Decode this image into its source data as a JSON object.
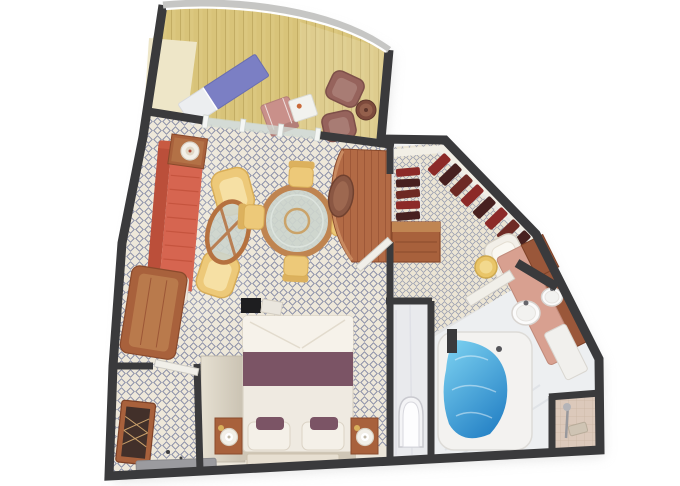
{
  "image": {
    "kind": "3d-floorplan-render",
    "subject": "suite floor plan with balcony, living room, walk-in closet, bedroom and bathroom"
  },
  "palette": {
    "walls": "#3a3a3c",
    "railing": "#c6c6c4",
    "railing_inner": "#ffffff",
    "deck": "#dbc77f",
    "deck_line": "#c3ad64",
    "cream_wall": "#eee6c8",
    "carpet": "#eee8da",
    "carpet_lattice": "#70789a",
    "tile": "#ece5d4",
    "tile_lattice": "#8890a8",
    "sofa": "#d66550",
    "sofa_back": "#bb4f3a",
    "sofa_cushion": "#efe9e0",
    "wood": "#a8613c",
    "wood_top": "#c08552",
    "desk_wood": "#b26a45",
    "desk_wood_line": "#9c5636",
    "armchair": "#edc979",
    "armchair_inner": "#f6e0a4",
    "armchair_edge": "#d9ae58",
    "dining_glass": "#ccd4cc",
    "table_rim": "#bf8450",
    "chaise_blue": "#7b7fc4",
    "chaise_foot": "#eceef0",
    "balcony_chair_pink": "#c9908a",
    "balcony_chair_mauve": "#96635c",
    "side_table_brown": "#7d4a3c",
    "clothes_a": "#8c2a28",
    "clothes_b": "#47201f",
    "clothes_c": "#6e2a24",
    "rail_white": "#e8e8e6",
    "bed_duvet": "#efeae1",
    "bed_fold": "#f6f2ea",
    "bed_runner": "#7b5465",
    "headboard": "#cfc6b6",
    "wardrobe": "#ddd6c7",
    "walkway": "#ece6da",
    "rug": "#e7dfd1",
    "wc_floor": "#e9eaed",
    "toilet": "#f4f4f6",
    "bath_floor": "#edeff1",
    "tub": "#f3f2f0",
    "water_top": "#7fd4f2",
    "water_deep": "#2a86c8",
    "counter": "#d8a090",
    "vanity_wood": "#9a573a",
    "cabinet_white": "#f1f0ed",
    "shower_tile": "#dcc9bb",
    "shower_tile_line": "#cbb6a5",
    "stool": "#e9c568",
    "mat": "#9b9b9f",
    "mirror_wood": "#a8613c",
    "mirror_glass": "#42302a",
    "door_leaf": "#f1efe9",
    "glass_divider": "#cfd8d2",
    "tv": "#1e1e20",
    "desk_chair": "#8a5743",
    "lamp": "#f2efe8",
    "dresser": "#a8613c",
    "nightstand": "#a8613c",
    "shadow": "#c9c9c9"
  },
  "rooms": [
    {
      "name": "balcony",
      "floor": "wood-deck",
      "furniture": [
        "chaise-lounge",
        "folding-chair",
        "small-table",
        "lounge-chair",
        "lounge-chair",
        "round-side-table"
      ]
    },
    {
      "name": "living-room",
      "floor": "lattice-carpet",
      "furniture": [
        "l-shaped-sofa",
        "side-table-with-lamp",
        "tub-armchair",
        "tub-armchair",
        "oval-coffee-table",
        "round-dining-table",
        "dining-chair",
        "dining-chair",
        "dining-chair",
        "dining-chair",
        "curved-desk",
        "desk-chair",
        "tv-cabinet",
        "tv"
      ]
    },
    {
      "name": "walk-in-closet",
      "floor": "mosaic-tile",
      "furniture": [
        "hanging-rail",
        "hanging-rail",
        "garments",
        "dresser"
      ]
    },
    {
      "name": "dressing-area",
      "floor": "mosaic-tile",
      "furniture": [
        "vanity-table",
        "round-stool"
      ]
    },
    {
      "name": "bedroom",
      "floor": "lattice-carpet",
      "furniture": [
        "double-bed",
        "pillows",
        "accent-runner",
        "nightstand",
        "nightstand",
        "lamps",
        "wardrobe",
        "rug"
      ]
    },
    {
      "name": "entry-hall",
      "floor": "lattice-carpet",
      "furniture": [
        "framed-mirror",
        "door-mat",
        "entry-door"
      ]
    },
    {
      "name": "toilet-room",
      "floor": "white",
      "furniture": [
        "toilet"
      ]
    },
    {
      "name": "bathroom",
      "floor": "white",
      "furniture": [
        "whirlpool-tub",
        "vanity-counter",
        "sink",
        "sink",
        "under-cabinet",
        "shower-stall",
        "shower-fixture"
      ]
    }
  ]
}
